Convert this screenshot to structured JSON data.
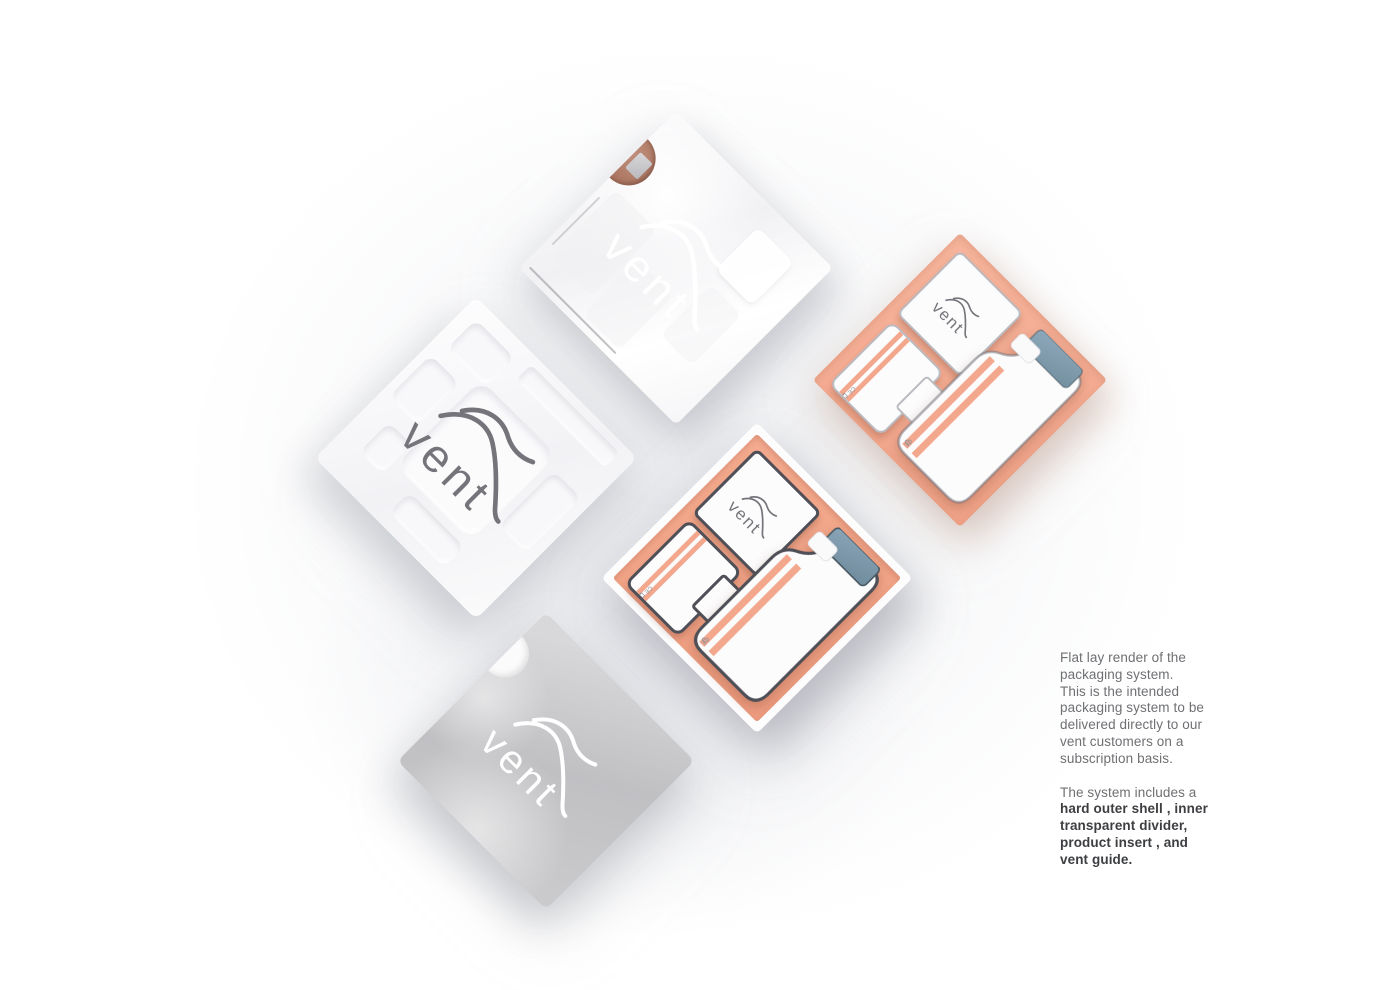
{
  "brand": {
    "name": "vent"
  },
  "marks": {
    "ce": "CE"
  },
  "caption": {
    "para1": "Flat lay render of the\npackaging system.\nThis is the intended\npackaging system to be\ndelivered directly to our\nvent customers on a\nsubscription basis.",
    "para2_intro": "The system includes a",
    "para2_bold": "hard outer shell , inner\ntransparent divider,\nproduct insert , and\nvent guide."
  },
  "colors": {
    "peach_insert": "#f0a286",
    "peach_stripe": "#f3a78c",
    "steel_blue_cap": "#7e99ad",
    "copper_notch": "#a9735f",
    "sleeve_gray": "#c4c4c7",
    "caption_gray": "#6f7073",
    "caption_dark": "#3d3e41"
  }
}
